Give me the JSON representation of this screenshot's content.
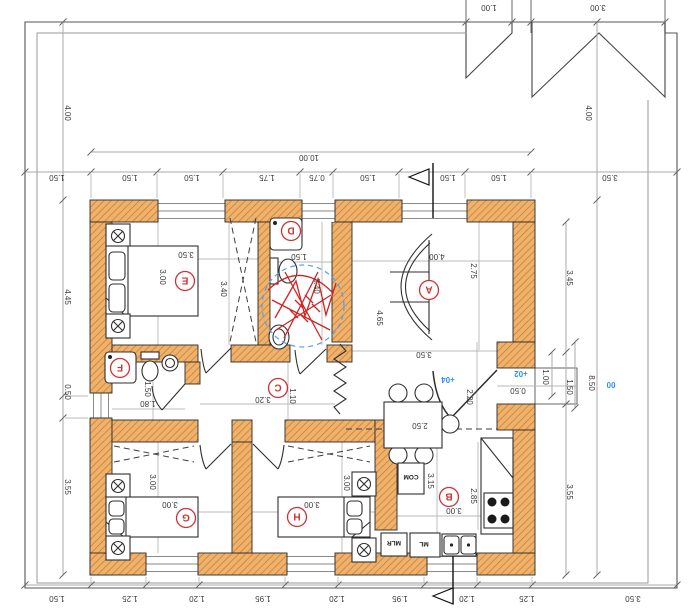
{
  "drawing": {
    "top_boxes": {
      "b1": "1.00",
      "b2": "3.00"
    },
    "top": {
      "overall": "10.00",
      "chain": [
        "1.50",
        "1.50",
        "1.50",
        "1.75",
        "0.75",
        "1.50",
        "1.50",
        "1.50",
        "3.50"
      ]
    },
    "bottom": {
      "chain": [
        "1.50",
        "1.25",
        "1.20",
        "1.95",
        "1.20",
        "1.95",
        "1.20",
        "1.25",
        "3.50"
      ]
    },
    "left": {
      "outside": "4.00",
      "chain": [
        "4.45",
        "0.50",
        "3.55"
      ]
    },
    "right": {
      "outside": "4.00",
      "chain": [
        "3.45",
        "1.00",
        "1.50",
        "3.55"
      ],
      "overall": "8.50",
      "level_zero": "00"
    },
    "rooms": {
      "A": {
        "letter": "A",
        "width": "4.00",
        "depth": "2.75",
        "sofa": "4.65",
        "south": "3.50"
      },
      "B": {
        "letter": "B",
        "width": "3.00",
        "len1": "3.15",
        "len2": "2.85",
        "table": "2.50",
        "com": "COM",
        "mlr": "MLR",
        "ml": "ML"
      },
      "C": {
        "letter": "C",
        "len": "3.20",
        "width": "1.10"
      },
      "D": {
        "letter": "D",
        "width": "1.50",
        "depth": "3.40"
      },
      "E": {
        "letter": "E",
        "width": "3.00",
        "north": "3.50",
        "closet": "3.40"
      },
      "F": {
        "letter": "F",
        "width": "1.80",
        "depth": "1.50"
      },
      "G": {
        "letter": "G",
        "width": "3.00",
        "depth": "3.00"
      },
      "H": {
        "letter": "H",
        "width": "3.00",
        "depth": "3.00"
      }
    },
    "entry": {
      "level_up": "+04",
      "level_mid": "+02",
      "step": "0.50",
      "door": "2.20"
    }
  }
}
